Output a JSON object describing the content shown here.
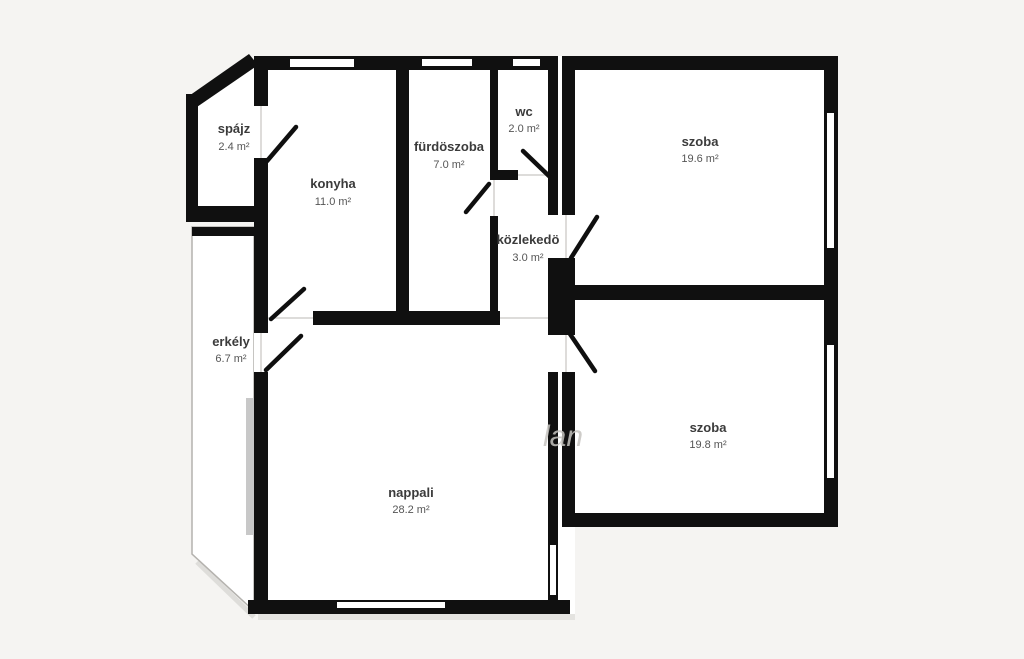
{
  "page": {
    "type": "floor-plan",
    "background_color": "#f5f4f2",
    "wall_color": "#101010",
    "room_fill_color": "#ffffff",
    "window_gray_color": "#c8c8c8",
    "outline_gray_color": "#b4b2ae"
  },
  "watermark": {
    "text": "lan"
  },
  "rooms": {
    "spajz": {
      "label": "spájz",
      "area": "2.4 m²"
    },
    "konyha": {
      "label": "konyha",
      "area": "11.0 m²"
    },
    "furdoszoba": {
      "label": "fürdöszoba",
      "area": "7.0 m²"
    },
    "wc": {
      "label": "wc",
      "area": "2.0 m²"
    },
    "kozlekedo": {
      "label": "közlekedö",
      "area": "3.0 m²"
    },
    "szoba_felso": {
      "label": "szoba",
      "area": "19.6 m²"
    },
    "szoba_also": {
      "label": "szoba",
      "area": "19.8 m²"
    },
    "nappali": {
      "label": "nappali",
      "area": "28.2 m²"
    },
    "erkely": {
      "label": "erkély",
      "area": "6.7 m²"
    }
  }
}
